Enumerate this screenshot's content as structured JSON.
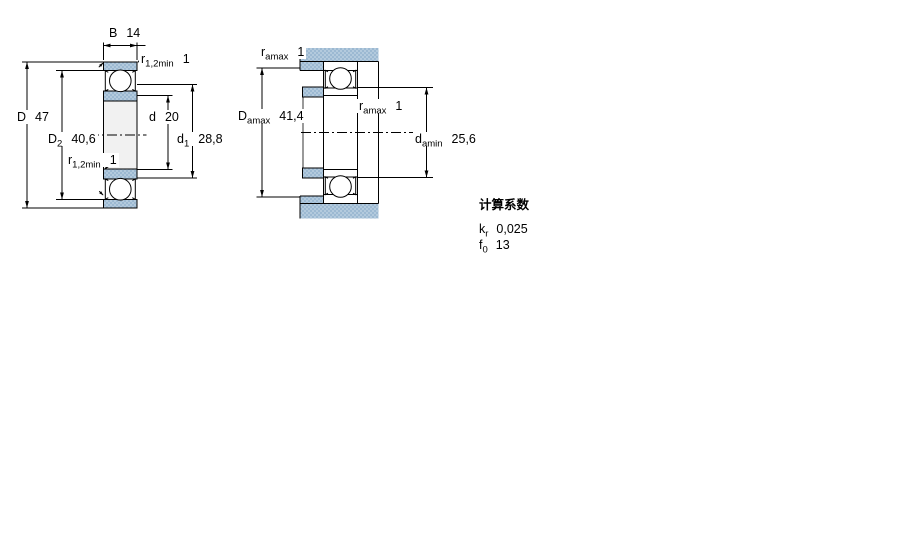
{
  "drawing": {
    "left_view": {
      "name": "bearing-cross-section-dimensions",
      "dim_B": {
        "base": "B",
        "value": "14"
      },
      "r12_top": {
        "base": "r",
        "sub": "1,2min",
        "value": "1"
      },
      "dim_D": {
        "base": "D",
        "value": "47"
      },
      "dim_D2": {
        "base": "D",
        "sub": "2",
        "value": "40,6"
      },
      "r12_low": {
        "base": "r",
        "sub": "1,2min",
        "value": "1"
      },
      "dim_d": {
        "base": "d",
        "value": "20"
      },
      "dim_d1": {
        "base": "d",
        "sub": "1",
        "value": "28,8"
      }
    },
    "right_view": {
      "name": "bearing-abutment-mounting-dimensions",
      "ra_top": {
        "base": "r",
        "sub": "amax",
        "value": "1"
      },
      "dim_Da": {
        "base": "D",
        "sub": "amax",
        "value": "41,4"
      },
      "ra_mid": {
        "base": "r",
        "sub": "amax",
        "value": "1"
      },
      "dim_da": {
        "base": "d",
        "sub": "amin",
        "value": "25,6"
      }
    },
    "calculation_factors": {
      "title": "计算系数",
      "kr": {
        "base": "k",
        "sub": "r",
        "value": "0,025"
      },
      "f0": {
        "base": "f",
        "sub": "0",
        "value": "13"
      }
    },
    "colors": {
      "hatch_blue": "#b3cadd",
      "hatch_blue_dark": "#9cb9d2",
      "outline": "#000000",
      "bore_fill": "#f1f1f1",
      "background": "#ffffff"
    }
  }
}
